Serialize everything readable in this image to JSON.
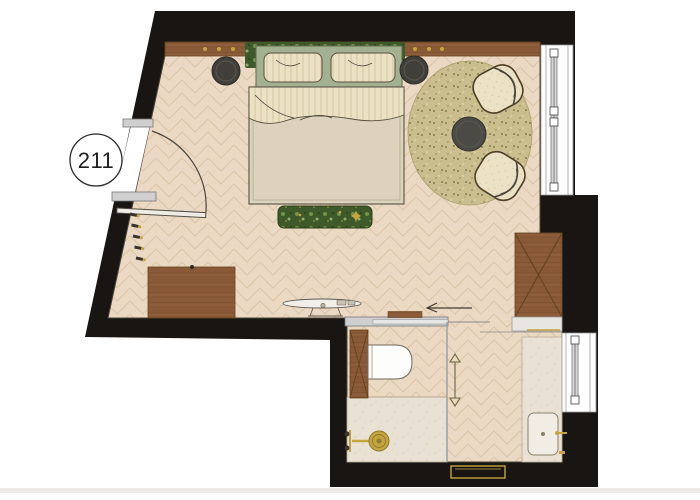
{
  "room": {
    "number": "211"
  },
  "colors": {
    "bg": "#ffffff",
    "wall": "#181512",
    "floor_base": "#ecd9c3",
    "floor_line": "#d9c3a7",
    "stone": "#e9e1d4",
    "stone_dot": "#c9bda9",
    "wood": "#8a5a38",
    "wood_dark": "#66431f",
    "wood_light": "#a5754d",
    "sage": "#a3b191",
    "sage_dark": "#5f6b4e",
    "cream": "#ebe1c5",
    "cream_line": "#d3c5a0",
    "blanket": "#ddd3bc",
    "blanket_line": "#56503f",
    "moss": "#3f5a2a",
    "moss_light": "#7fa04f",
    "moss_pale": "#b5cc8a",
    "gold": "#c3a43f",
    "dark_furniture": "#413f3a",
    "dark_ring": "#5a5850",
    "rug": "#cabe8e",
    "rug_dot": "#867c49",
    "rug_light": "#e9e2b8",
    "glass": "#9aa3a3",
    "door_gray": "#cfcfcf",
    "frame_gray": "#8f8f8f",
    "white": "#ffffff",
    "outline": "#4a443a",
    "label": "#1e1e1e",
    "shadow": "#e8e5e1"
  },
  "furniture_items": [
    "double-bed",
    "headboard",
    "pillow-left",
    "pillow-right",
    "duvet",
    "foot-bench",
    "nightstand-stool-left",
    "nightstand-stool-right",
    "round-rug",
    "coffee-table",
    "armchair-top",
    "armchair-bottom",
    "desk-dresser",
    "coat-hooks",
    "entry-door",
    "wall-wood-panel",
    "moss-panel",
    "console-shelf",
    "wardrobe",
    "wardrobe-shelf",
    "sliding-door",
    "glass-partition",
    "toilet",
    "toilet-cistern",
    "shower-head",
    "shower-valve",
    "vanity-counter",
    "sink",
    "faucet",
    "towel-rail",
    "towel-bench",
    "window-right-top",
    "window-right-bottom"
  ]
}
